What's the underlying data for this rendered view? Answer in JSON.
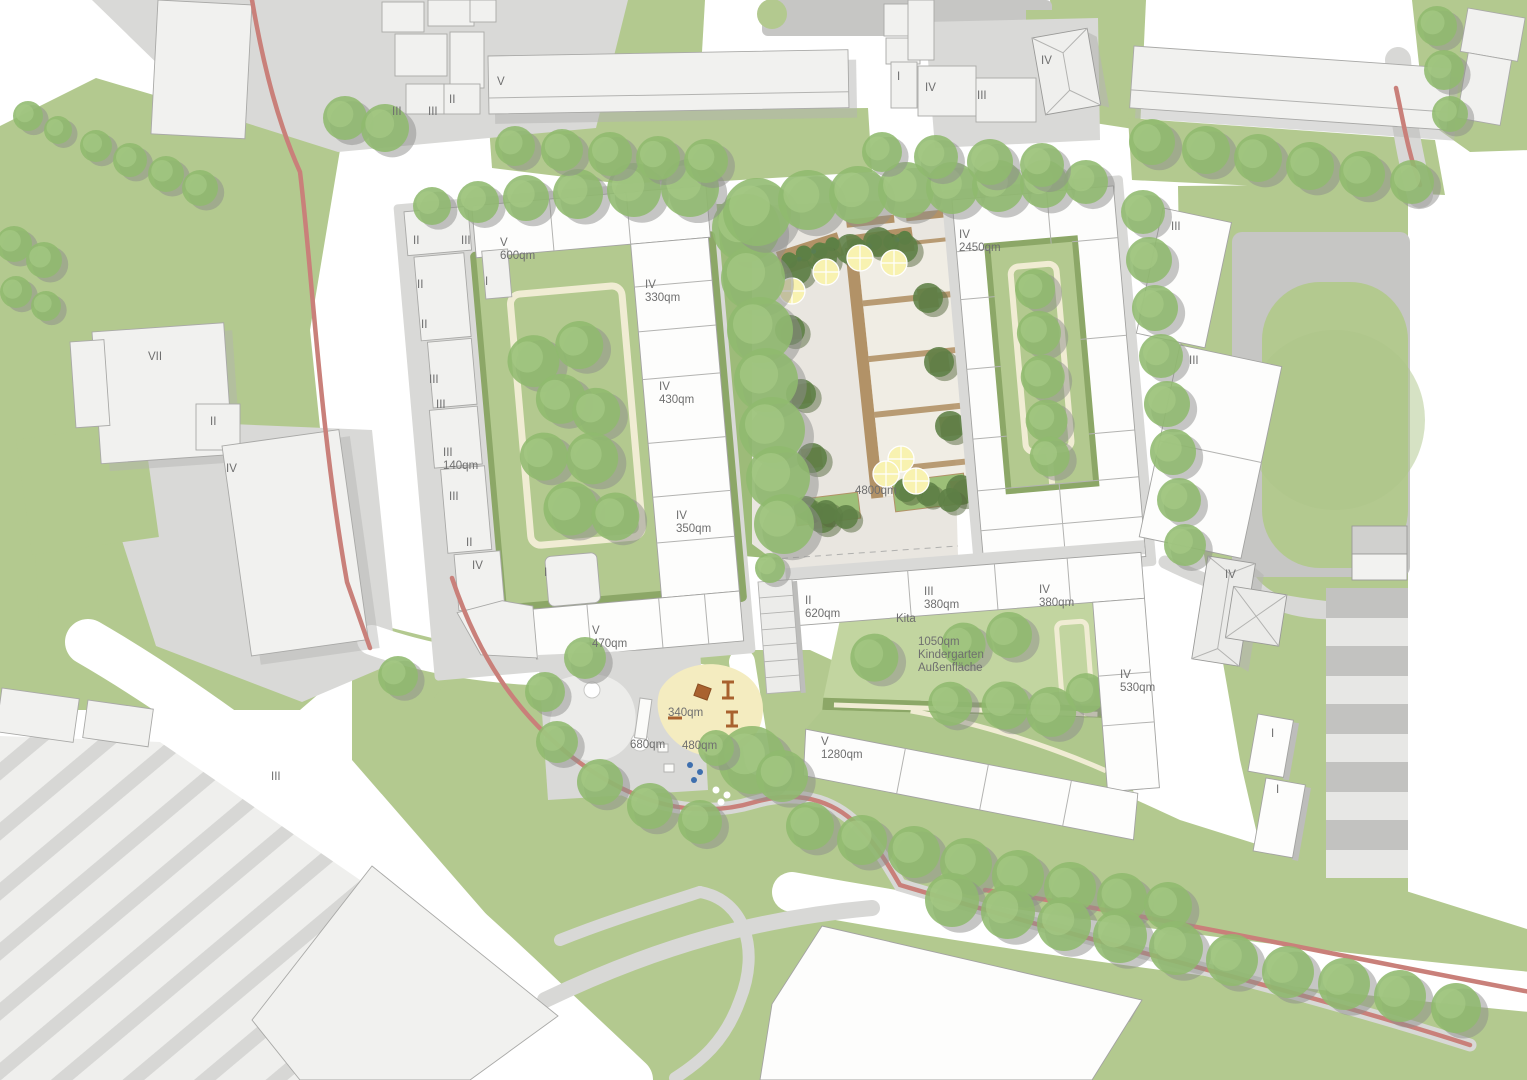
{
  "plan": {
    "kind": "urban-design-site-plan",
    "colors": {
      "grass": "#b3c98f",
      "tree": "#8fba6e",
      "treeShadow": "#8d8d8b",
      "building": "#fdfdfc",
      "contextBuilding": "#f1f1ef",
      "sidewalk": "#d9d9d7",
      "plaza": "#e9e6e0",
      "court": "#c6c6c4",
      "bikePath": "#c9807a",
      "hedge": "#8ca767",
      "creamPath": "#f0ecd3",
      "planter": "#b29267",
      "sand": "#f4ecc0",
      "umbrella": "#f8f2b0",
      "label": "#6f6f6f"
    },
    "labels": [
      {
        "text": "V",
        "x": 497,
        "y": 78
      },
      {
        "text": "III",
        "x": 392,
        "y": 108
      },
      {
        "text": "III",
        "x": 428,
        "y": 108
      },
      {
        "text": "II",
        "x": 449,
        "y": 96
      },
      {
        "text": "I",
        "x": 897,
        "y": 73
      },
      {
        "text": "IV",
        "x": 925,
        "y": 84
      },
      {
        "text": "III",
        "x": 977,
        "y": 92
      },
      {
        "text": "IV",
        "x": 1041,
        "y": 57
      },
      {
        "text": "III",
        "x": 1171,
        "y": 223
      },
      {
        "text": "III",
        "x": 1189,
        "y": 357
      },
      {
        "text": "VII",
        "x": 148,
        "y": 353
      },
      {
        "text": "II",
        "x": 210,
        "y": 418
      },
      {
        "text": "IV",
        "x": 226,
        "y": 465
      },
      {
        "text": "III",
        "x": 271,
        "y": 773
      },
      {
        "text": "II",
        "x": 413,
        "y": 237
      },
      {
        "text": "III",
        "x": 461,
        "y": 237
      },
      {
        "text": "V",
        "x": 500,
        "y": 239
      },
      {
        "text": "600qm",
        "x": 500,
        "y": 252
      },
      {
        "text": "I",
        "x": 485,
        "y": 278
      },
      {
        "text": "II",
        "x": 417,
        "y": 281
      },
      {
        "text": "II",
        "x": 421,
        "y": 321
      },
      {
        "text": "III",
        "x": 429,
        "y": 376
      },
      {
        "text": "III",
        "x": 436,
        "y": 401
      },
      {
        "text": "III",
        "x": 443,
        "y": 449
      },
      {
        "text": "140qm",
        "x": 443,
        "y": 462
      },
      {
        "text": "III",
        "x": 449,
        "y": 493
      },
      {
        "text": "II",
        "x": 466,
        "y": 539
      },
      {
        "text": "IV",
        "x": 472,
        "y": 562
      },
      {
        "text": "I",
        "x": 544,
        "y": 569
      },
      {
        "text": "IV",
        "x": 645,
        "y": 281
      },
      {
        "text": "330qm",
        "x": 645,
        "y": 294
      },
      {
        "text": "IV",
        "x": 659,
        "y": 383
      },
      {
        "text": "430qm",
        "x": 659,
        "y": 396
      },
      {
        "text": "IV",
        "x": 676,
        "y": 512
      },
      {
        "text": "350qm",
        "x": 676,
        "y": 525
      },
      {
        "text": "V",
        "x": 592,
        "y": 627
      },
      {
        "text": "470qm",
        "x": 592,
        "y": 640
      },
      {
        "text": "4800qm",
        "x": 855,
        "y": 487
      },
      {
        "text": "IV",
        "x": 959,
        "y": 231
      },
      {
        "text": "2450qm",
        "x": 959,
        "y": 244
      },
      {
        "text": "II",
        "x": 805,
        "y": 597
      },
      {
        "text": "620qm",
        "x": 805,
        "y": 610
      },
      {
        "text": "Kita",
        "x": 896,
        "y": 615
      },
      {
        "text": "III",
        "x": 924,
        "y": 588
      },
      {
        "text": "380qm",
        "x": 924,
        "y": 601
      },
      {
        "text": "IV",
        "x": 1039,
        "y": 586
      },
      {
        "text": "380qm",
        "x": 1039,
        "y": 599
      },
      {
        "text": "1050qm",
        "x": 918,
        "y": 638
      },
      {
        "text": "Kindergarten",
        "x": 918,
        "y": 651
      },
      {
        "text": "Außenfläche",
        "x": 918,
        "y": 664
      },
      {
        "text": "IV",
        "x": 1120,
        "y": 671
      },
      {
        "text": "530qm",
        "x": 1120,
        "y": 684
      },
      {
        "text": "V",
        "x": 821,
        "y": 738
      },
      {
        "text": "1280qm",
        "x": 821,
        "y": 751
      },
      {
        "text": "340qm",
        "x": 668,
        "y": 709
      },
      {
        "text": "680qm",
        "x": 630,
        "y": 741
      },
      {
        "text": "480qm",
        "x": 682,
        "y": 742
      },
      {
        "text": "IV",
        "x": 1225,
        "y": 571
      },
      {
        "text": "I",
        "x": 1271,
        "y": 730
      },
      {
        "text": "I",
        "x": 1276,
        "y": 786
      }
    ]
  }
}
